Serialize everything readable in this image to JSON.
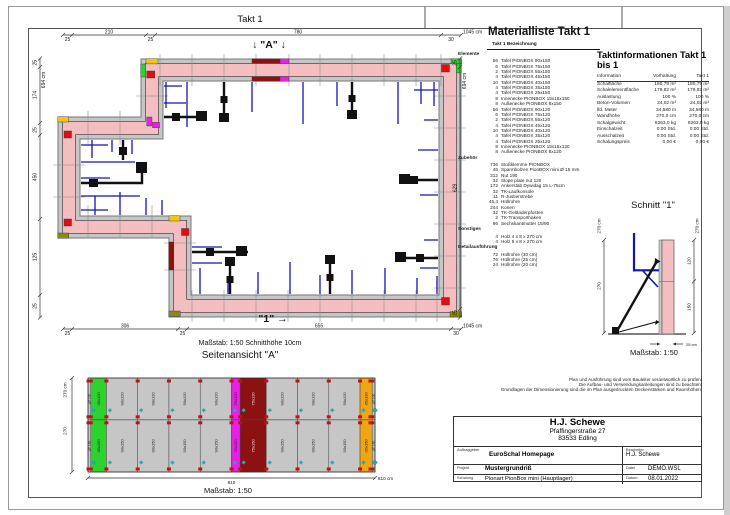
{
  "page": {
    "takt_title": "Takt 1",
    "marker_a": "↓ \"A\" ↓",
    "marker_1": "\"1\" →",
    "plan_scale_note": "Maßstab: 1:50   Schnitthöhe 10cm"
  },
  "plan": {
    "dims": {
      "top": {
        "segs": [
          "25",
          "210",
          "25",
          "780",
          "30"
        ],
        "total": "1045 cm"
      },
      "bottom": {
        "segs": [
          "25",
          "306",
          "25",
          "655",
          "30"
        ],
        "total": "1045 cm"
      },
      "left": {
        "segs": [
          "25",
          "174",
          "25",
          "450",
          "125",
          "25"
        ],
        "total": "694 cm"
      },
      "right": {
        "segs": [
          "25",
          "629",
          "25"
        ],
        "total": "694 cm"
      }
    }
  },
  "materialliste": {
    "title": "Materialliste  Takt 1",
    "col_header": "Takt 1  Bezeichnung",
    "groups": [
      {
        "name": "Elemente",
        "items": [
          [
            "56",
            "Tafel PIONBOX 90x150"
          ],
          [
            "6",
            "Tafel PIONBOX 75x150"
          ],
          [
            "2",
            "Tafel PIONBOX 55x150"
          ],
          [
            "4",
            "Tafel PIONBOX 45x150"
          ],
          [
            "10",
            "Tafel PIONBOX 40x150"
          ],
          [
            "4",
            "Tafel PIONBOX 35x150"
          ],
          [
            "4",
            "Tafel PIONBOX 25x150"
          ],
          [
            "8",
            "Innenecke PIONBOX 15x15x150"
          ],
          [
            "8",
            "Außenecke PIONBOX 8x150"
          ],
          [
            "56",
            "Tafel PIONBOX 90x120"
          ],
          [
            "6",
            "Tafel PIONBOX 75x120"
          ],
          [
            "2",
            "Tafel PIONBOX 55x120"
          ],
          [
            "4",
            "Tafel PIONBOX 45x120"
          ],
          [
            "10",
            "Tafel PIONBOX 40x120"
          ],
          [
            "4",
            "Tafel PIONBOX 35x120"
          ],
          [
            "4",
            "Tafel PIONBOX 25x120"
          ],
          [
            "8",
            "Innenecke PIONBOX 15x15x120"
          ],
          [
            "8",
            "Außenecke PIONBOX 8x120"
          ]
        ]
      },
      {
        "name": "Zubehör",
        "items": [
          [
            "736",
            "Stoßklemme PIONBOX"
          ],
          [
            "46",
            "Spannbolzen PionBOX mini Ø 15 mm"
          ],
          [
            "312",
            "Nut 190"
          ],
          [
            "32",
            "Slope plate nut 120"
          ],
          [
            "172",
            "Ankerstab Dywidag 15 L-75cm"
          ],
          [
            "32",
            "TK-Laufkonsole"
          ],
          [
            "11",
            "R-Justierstrebe"
          ],
          [
            "45,4",
            "Hüllrohre"
          ],
          [
            "244",
            "Konen"
          ],
          [
            "32",
            "TK-Geländerpfosten"
          ],
          [
            "2",
            "TK-Transporthaken"
          ],
          [
            "96",
            "Sechskantmutter 15/90"
          ]
        ]
      },
      {
        "name": "Sonstiges",
        "items": [
          [
            "4",
            "Holz 4 x 8 x 270 cm"
          ],
          [
            "4",
            "Holz 5 x 8 x 270 cm"
          ]
        ]
      },
      {
        "name": "Detailausführung",
        "items": [
          [
            "72",
            "Hüllrohre (30 cm)"
          ],
          [
            "76",
            "Hüllrohre (25 cm)"
          ],
          [
            "24",
            "Hüllrohre (20 cm)"
          ]
        ]
      }
    ]
  },
  "taktinfo": {
    "title": "Taktinformationen  Takt 1 bis 1",
    "columns": [
      "Information",
      "Vorhaltung",
      "Takt 1"
    ],
    "rows": [
      [
        "Schalfläche",
        "180,79 m²",
        "180,79 m²"
      ],
      [
        "Schalelementfläche",
        "179,82 m²",
        "179,82 m²"
      ],
      [
        "Auslastung",
        "100 %",
        "100 %"
      ],
      [
        "Beton-Volumen",
        "24,02 m³",
        "24,02 m³"
      ],
      [
        "lfd. Meter",
        "34,580 m",
        "34,580 m"
      ],
      [
        "Wandhöhe",
        "270,0 cm",
        "270,0 cm"
      ],
      [
        "Schalgewicht",
        "8263,0 kg",
        "8263,0 kg"
      ],
      [
        "Einschalzeit",
        "0:00 Std.",
        "0:00 Std."
      ],
      [
        "Ausschalzeit",
        "0:00 Std.",
        "0:00 Std."
      ],
      [
        "Schalungspreis",
        "0,00 €",
        "0,00 €"
      ]
    ]
  },
  "schnitt": {
    "title": "Schnitt  \"1\"",
    "scale": "Maßstab:  1:50",
    "dim_left_total": "270 cm",
    "dim_left": "270",
    "dim_right_total": "270 cm",
    "dim_right_upper": "120",
    "dim_right_lower": "150",
    "wall_width": "25 cm"
  },
  "seitenansicht": {
    "title": "Seitenansicht \"A\"",
    "scale": "Maßstab:  1:50",
    "dim_height_total": "270 cm",
    "dim_height": "270",
    "dim_width": "810",
    "dim_width_total": "810 cm",
    "panels": [
      {
        "w": 8,
        "c": "#c6c6c6",
        "t": "AE 120",
        "b": "AE 150"
      },
      {
        "w": 45,
        "c": "#2cd32c",
        "t": "45x120",
        "b": "45x150"
      },
      {
        "w": 90,
        "c": "#c6c6c6",
        "t": "90x120",
        "b": "90x150"
      },
      {
        "w": 90,
        "c": "#c6c6c6",
        "t": "90x120",
        "b": "90x150"
      },
      {
        "w": 90,
        "c": "#c6c6c6",
        "t": "90x120",
        "b": "90x150"
      },
      {
        "w": 90,
        "c": "#c6c6c6",
        "t": "90x120",
        "b": "90x150"
      },
      {
        "w": 25,
        "c": "#ea1eea",
        "t": "25x120",
        "b": "25x150"
      },
      {
        "w": 75,
        "c": "#8c1111",
        "t": "75x120",
        "b": "75x150"
      },
      {
        "w": 90,
        "c": "#c6c6c6",
        "t": "90x120",
        "b": "90x150"
      },
      {
        "w": 90,
        "c": "#c6c6c6",
        "t": "90x120",
        "b": "90x150"
      },
      {
        "w": 90,
        "c": "#c6c6c6",
        "t": "90x120",
        "b": "90x150"
      },
      {
        "w": 35,
        "c": "#f0a513",
        "t": "35x120",
        "b": "35x150"
      },
      {
        "w": 8,
        "c": "#c6c6c6",
        "t": "AE 120",
        "b": "AE 150"
      }
    ]
  },
  "disclaimer": [
    "Plan und Ausführung sind vom Bauleiter verantwortlich zu prüfen!",
    "Die Aufbau- und Verwendungsanleitungen sind zu beachten!",
    "Grundlagen der Dimensionierung sind die im Plan ausgedruckten Deckenstärken und Raumhöhen."
  ],
  "titleblock": {
    "company": "H.J. Schewe",
    "street": "Pfaffingerstraße 27",
    "city": "83533 Edling",
    "labels": {
      "auftraggeber": "Auftraggeber",
      "bearbeiter": "Bearbeiter",
      "projekt": "Projekt",
      "datei": "Datei",
      "schalung": "Schalung",
      "datum": "Datum"
    },
    "auftraggeber": "EuroSchal Homepage",
    "bearbeiter": "H.J. Schewe",
    "projekt": "Mustergrundriß",
    "datei": "DEMO.WSL",
    "schalung": "Pionart PionBox mini (Hauptlager)",
    "datum": "08.01.2022"
  },
  "colors": {
    "wall_pink": "#f4bec1",
    "panel_gray": "#c6c6c6",
    "highlight_darkred": "#8c1111",
    "highlight_magenta": "#ea1eea",
    "highlight_green": "#2cd32c",
    "highlight_orange": "#f0a513",
    "corner_olive": "#8a8a12",
    "corner_red": "#dd1111",
    "tie_blue": "#1414b4",
    "clamp_teal": "#2ba8a8"
  }
}
